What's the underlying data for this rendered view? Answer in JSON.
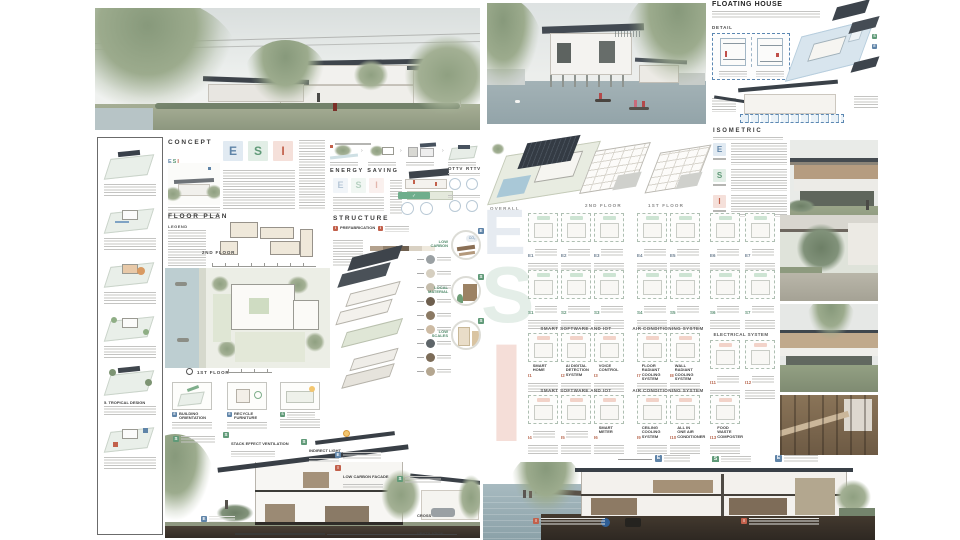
{
  "board_left": {
    "concept": {
      "title": "CONCEPT",
      "e": "E",
      "s": "S",
      "i": "I",
      "logo_sub": "H O U S E"
    },
    "energy": {
      "title": "ENERGY SAVING",
      "ottv": "OTTV",
      "rttv": "RTTV"
    },
    "floorplan": {
      "title": "FLOOR PLAN",
      "legend": "LEGEND",
      "floor2": "2ND FLOOR",
      "floor1": "1ST FLOOR"
    },
    "structure": {
      "title": "STRUCTURE",
      "tag1": "PREFABRICATION",
      "circle1": "LOW CARBON",
      "circle1_badge": "E",
      "circle1_co2": "CO₂",
      "circle2": "LOCAL MATERIAL",
      "circle2_badge": "S",
      "circle3": "LOW SCALES",
      "circle3_badge": "S"
    },
    "eco": {
      "p1_badge": "E",
      "p1": "BUILDING ORIENTATION",
      "p2_badge": "E",
      "p2": "RECYCLE FURNITURE",
      "p3_badge": "S"
    },
    "sidebar": {
      "step5": "5. TROPICAL DESIGN"
    },
    "section": {
      "tag_e": "E",
      "tag_s": "S",
      "tag_i": "I",
      "stack": "STACK EFFECT VENTILATION",
      "indirect": "INDIRECT LIGHT",
      "facade": "LOW CARBON FACADE",
      "cross": "CROSS VENTILATION"
    }
  },
  "board_right": {
    "floating": {
      "title": "FLOATING HOUSE",
      "detail": "DETAIL"
    },
    "isometric": {
      "title": "ISOMETRIC",
      "e": "E",
      "s": "S",
      "i": "I"
    },
    "axons": {
      "overall": "OVERALL",
      "floor2": "2ND FLOOR",
      "floor1": "1ST FLOOR"
    },
    "grid": {
      "header_iot": "SMART SOFTWARE AND IOT",
      "header_ac": "AIR CONDITIONING SYSTEM",
      "header_elec": "ELECTRICAL SYSTEM",
      "watermark_e": "E",
      "watermark_s": "S",
      "watermark_i": "I",
      "codes_e": [
        "E1",
        "E2",
        "E3",
        "E4",
        "E5",
        "E6",
        "E7"
      ],
      "codes_s": [
        "S1",
        "S2",
        "S3",
        "S4",
        "S5",
        "S6",
        "S7"
      ],
      "codes_ia": [
        "I1",
        "I2",
        "I3",
        "I7",
        "I8",
        "I11",
        "I12"
      ],
      "codes_ib": [
        "I4",
        "I5",
        "I6",
        "I9",
        "I10",
        "I13"
      ],
      "labels_ia": [
        "SMART HOME",
        "AI DIGITAL DETECTION SYSTEM",
        "VOICE CONTROL",
        "FLOOR RADIANT COOLING SYSTEM",
        "WALL RADIANT COOLING SYSTEM"
      ],
      "labels_ib": [
        "",
        "",
        "SMART METER",
        "CEILING COOLING SYSTEM",
        "ALL IN ONE AIR CONDITIONER",
        "FOOD WASTE COMPOSTER"
      ]
    },
    "legend": {
      "e": "E",
      "s": "S"
    }
  },
  "colors": {
    "e_blue": "#5f84a8",
    "s_green": "#609a78",
    "i_red": "#c2604b",
    "roof_dark": "#3b4148",
    "detail_dashed_blue": "#5b87b2"
  }
}
